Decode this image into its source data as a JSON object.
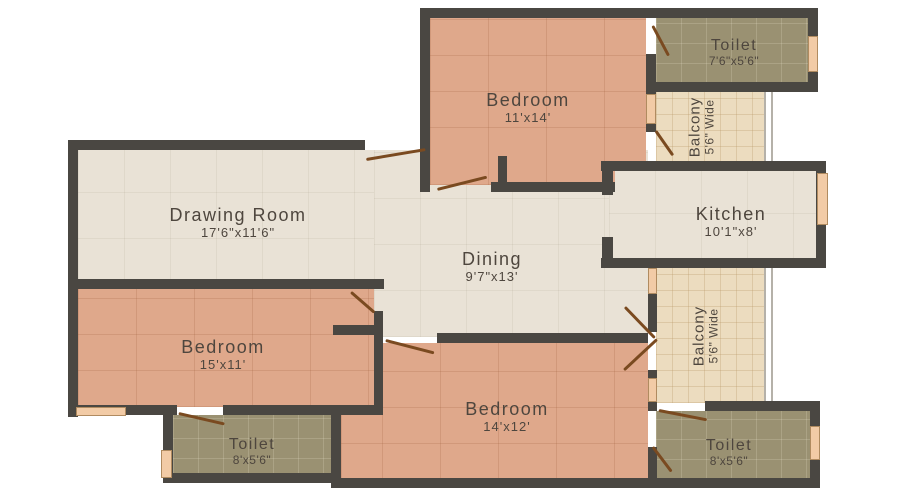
{
  "rooms": {
    "drawing_room": {
      "name": "Drawing Room",
      "dims": "17'6\"x11'6\""
    },
    "dining": {
      "name": "Dining",
      "dims": "9'7\"x13'"
    },
    "kitchen": {
      "name": "Kitchen",
      "dims": "10'1\"x8'"
    },
    "bedroom_top": {
      "name": "Bedroom",
      "dims": "11'x14'"
    },
    "bedroom_left": {
      "name": "Bedroom",
      "dims": "15'x11'"
    },
    "bedroom_bottom": {
      "name": "Bedroom",
      "dims": "14'x12'"
    },
    "toilet_top_right": {
      "name": "Toilet",
      "dims": "7'6\"x5'6\""
    },
    "toilet_bottom_left": {
      "name": "Toilet",
      "dims": "8'x5'6\""
    },
    "toilet_bottom_right": {
      "name": "Toilet",
      "dims": "8'x5'6\""
    },
    "balcony_top": {
      "name": "Balcony",
      "dims": "5'6\" Wide"
    },
    "balcony_right": {
      "name": "Balcony",
      "dims": "5'6\" Wide"
    }
  },
  "colors": {
    "wall": "#4a4742",
    "floor_light": "#e9e2d6",
    "floor_bedroom": "#dfa88b",
    "floor_toilet": "#9a9172",
    "floor_balcony": "#ecdcbf",
    "window_sill": "#f2cba6",
    "door_swing": "#7a4a20",
    "label_text": "#4e463e",
    "background": "#ffffff"
  }
}
